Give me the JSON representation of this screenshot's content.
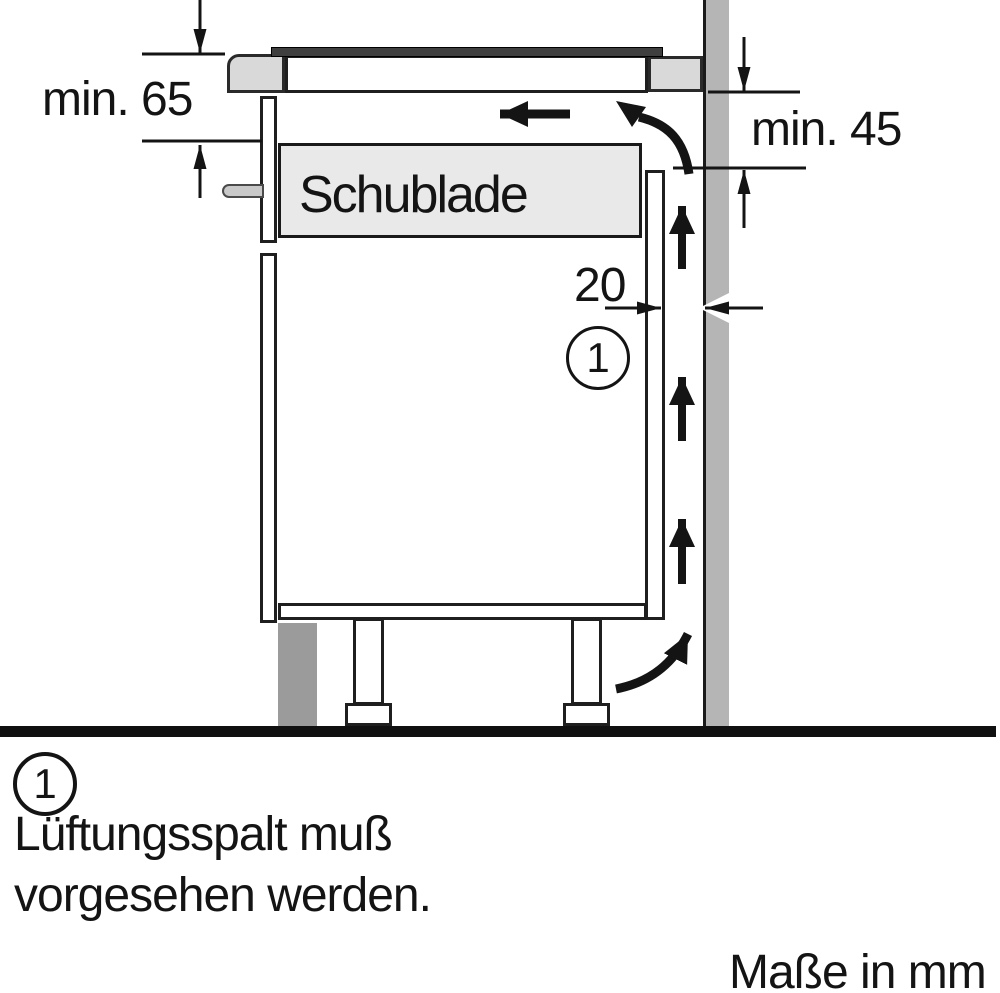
{
  "diagram": {
    "title_hint": "Einbauzeichnung Kochfeld über Schublade",
    "labels": {
      "dim_worktop_to_drawer": "min. 65",
      "dim_worktop_to_panel": "min. 45",
      "dim_rear_gap": "20",
      "drawer": "Schublade",
      "callout_number": "1"
    },
    "footnote": {
      "marker": "1",
      "line1": "Lüftungsspalt muß",
      "line2": "vorgesehen werden."
    },
    "units_note": "Maße in mm",
    "colors": {
      "wall": "#b5b5b5",
      "worktop": "#d9d9d9",
      "drawer": "#e9e9e9",
      "plinth": "#9b9b9b",
      "handle": "#c9c9c9",
      "glass": "#3f3f3f",
      "line": "#1a1a1a"
    }
  }
}
